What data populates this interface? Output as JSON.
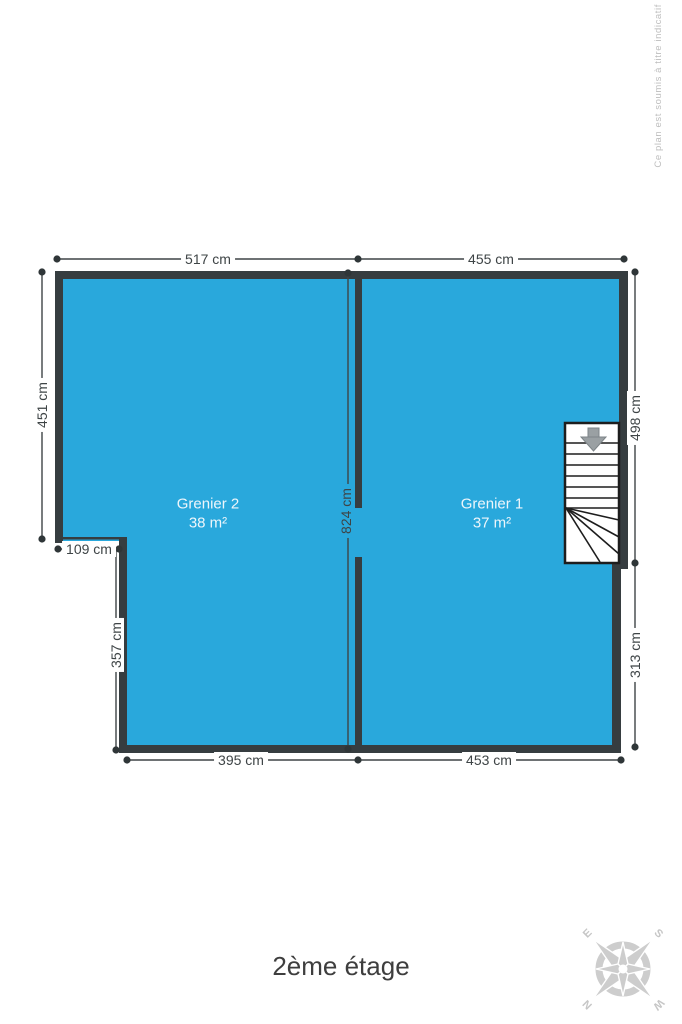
{
  "plan": {
    "title": "2ème étage",
    "watermark": "Ce plan est soumis à titre indicatif",
    "rooms": [
      {
        "name": "Grenier 2",
        "area": "38 m²"
      },
      {
        "name": "Grenier 1",
        "area": "37 m²"
      }
    ],
    "dimensions": {
      "top_left": "517 cm",
      "top_right": "455 cm",
      "left": "451 cm",
      "notch": "109 cm",
      "left_lower": "357 cm",
      "center": "824 cm",
      "right_upper": "498 cm",
      "right_lower": "313 cm",
      "bottom_left": "395 cm",
      "bottom_right": "453 cm"
    },
    "compass": {
      "north": "N",
      "east": "E",
      "south": "S",
      "west": "W"
    },
    "colors": {
      "floor": "#29a8dc",
      "wall": "#363d40",
      "dimension": "#3e4446",
      "stairs_outline": "#1d1d1d",
      "watermark": "#bdbdbd"
    }
  }
}
